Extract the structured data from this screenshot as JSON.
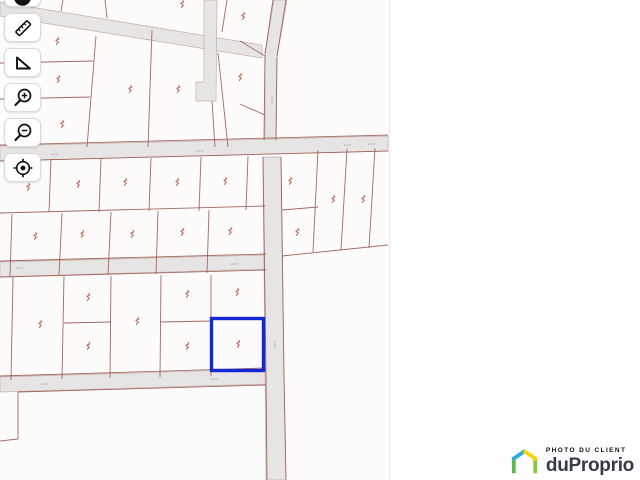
{
  "toolbar": {
    "buttons": [
      {
        "name": "marker",
        "icon": "marker-icon"
      },
      {
        "name": "measure-distance",
        "icon": "ruler-icon"
      },
      {
        "name": "measure-angle",
        "icon": "protractor-icon"
      },
      {
        "name": "zoom-in",
        "icon": "zoom-in-icon"
      },
      {
        "name": "zoom-out",
        "icon": "zoom-out-icon"
      },
      {
        "name": "locate",
        "icon": "locate-target-icon"
      }
    ]
  },
  "logo": {
    "tagline": "PHOTO DU CLIENT",
    "brand": "duProprio",
    "house_colors": {
      "left_leg": "#5cb947",
      "left_roof": "#29aae2",
      "right_roof": "#ffd203",
      "right_leg": "#8dc63f"
    },
    "brand_color": "#363a44"
  },
  "map": {
    "colors": {
      "background": "#fdfcfb",
      "road_fill": "#e6e4e2",
      "road_stroke": "#bfaea6",
      "lot_line": "#9b5a52",
      "lot_label": "#b2453c",
      "street_text": "#a5a09a",
      "selection": "#1527d4"
    },
    "roads": [
      {
        "points": "0,2 262,45 262,58 0,16"
      },
      {
        "points": "274,0 287,0 277,57 276,140 265,140 265,54"
      },
      {
        "points": "204,0 217,0 216,101 196,101 196,82 204,82"
      },
      {
        "points": "0,146 388,136 388,151 0,161"
      },
      {
        "points": "0,262 266,255 266,269 0,277"
      },
      {
        "points": "0,377 266,369 268,384 0,392"
      },
      {
        "points": "263,157 281,157 284,375 286,480 266,480 265,375"
      }
    ],
    "lot_lines": [
      [
        0,
        63,
        93,
        61
      ],
      [
        0,
        99,
        90,
        97
      ],
      [
        96,
        36,
        87,
        147
      ],
      [
        152,
        30,
        148,
        147
      ],
      [
        212,
        101,
        215,
        147
      ],
      [
        218,
        53,
        228,
        147
      ],
      [
        227,
        0,
        222,
        32
      ],
      [
        63,
        0,
        61,
        11
      ],
      [
        105,
        0,
        107,
        18
      ],
      [
        240,
        41,
        265,
        56
      ],
      [
        240,
        104,
        265,
        115
      ],
      [
        273,
        0,
        265,
        54
      ],
      [
        286,
        0,
        277,
        56
      ],
      [
        265,
        55,
        264,
        140
      ],
      [
        277,
        57,
        276,
        140
      ],
      [
        0,
        145,
        388,
        135
      ],
      [
        0,
        161,
        388,
        151
      ],
      [
        0,
        261,
        266,
        254
      ],
      [
        0,
        277,
        266,
        270
      ],
      [
        0,
        376,
        266,
        368
      ],
      [
        18,
        392,
        266,
        385
      ],
      [
        263,
        157,
        266,
        375
      ],
      [
        281,
        157,
        284,
        375
      ],
      [
        266,
        375,
        267,
        480
      ],
      [
        284,
        375,
        286,
        480
      ],
      [
        51,
        159,
        49,
        212
      ],
      [
        101,
        158,
        99,
        212
      ],
      [
        151,
        158,
        149,
        211
      ],
      [
        201,
        157,
        199,
        211
      ],
      [
        248,
        156,
        246,
        210
      ],
      [
        0,
        213,
        265,
        206
      ],
      [
        12,
        214,
        10,
        276
      ],
      [
        62,
        213,
        59,
        275
      ],
      [
        111,
        212,
        108,
        275
      ],
      [
        158,
        211,
        156,
        274
      ],
      [
        209,
        210,
        207,
        273
      ],
      [
        318,
        150,
        313,
        252
      ],
      [
        347,
        149,
        341,
        250
      ],
      [
        375,
        148,
        369,
        248
      ],
      [
        282,
        210,
        318,
        207
      ],
      [
        282,
        256,
        388,
        245
      ],
      [
        13,
        277,
        11,
        380
      ],
      [
        64,
        276,
        62,
        379
      ],
      [
        111,
        276,
        110,
        378
      ],
      [
        161,
        275,
        160,
        377
      ],
      [
        211,
        275,
        211,
        376
      ],
      [
        64,
        323,
        111,
        322
      ],
      [
        161,
        322,
        211,
        321
      ],
      [
        18,
        392,
        18,
        439
      ],
      [
        18,
        439,
        0,
        441
      ]
    ],
    "lot_labels": [
      [
        57,
        42
      ],
      [
        58,
        80
      ],
      [
        130,
        90
      ],
      [
        178,
        90
      ],
      [
        240,
        78
      ],
      [
        62,
        125
      ],
      [
        182,
        5
      ],
      [
        243,
        17
      ],
      [
        28,
        188
      ],
      [
        78,
        185
      ],
      [
        125,
        183
      ],
      [
        177,
        183
      ],
      [
        225,
        182
      ],
      [
        290,
        182
      ],
      [
        333,
        200
      ],
      [
        363,
        200
      ],
      [
        35,
        237
      ],
      [
        82,
        235
      ],
      [
        132,
        235
      ],
      [
        182,
        233
      ],
      [
        230,
        232
      ],
      [
        297,
        233
      ],
      [
        40,
        325
      ],
      [
        88,
        298
      ],
      [
        88,
        347
      ],
      [
        137,
        322
      ],
      [
        187,
        295
      ],
      [
        187,
        347
      ],
      [
        237,
        293
      ],
      [
        238,
        345
      ]
    ],
    "street_marks": [
      [
        55,
        154,
        -2
      ],
      [
        200,
        151,
        -2
      ],
      [
        348,
        145,
        -2
      ],
      [
        372,
        144,
        -2
      ],
      [
        150,
        40,
        9
      ],
      [
        20,
        268,
        -2
      ],
      [
        235,
        264,
        -2
      ],
      [
        45,
        384,
        -2
      ],
      [
        215,
        379,
        -2
      ],
      [
        272,
        100,
        90
      ],
      [
        275,
        345,
        88
      ]
    ],
    "selected_lot": {
      "x": 211.5,
      "y": 318.5,
      "w": 52,
      "h": 52
    }
  }
}
